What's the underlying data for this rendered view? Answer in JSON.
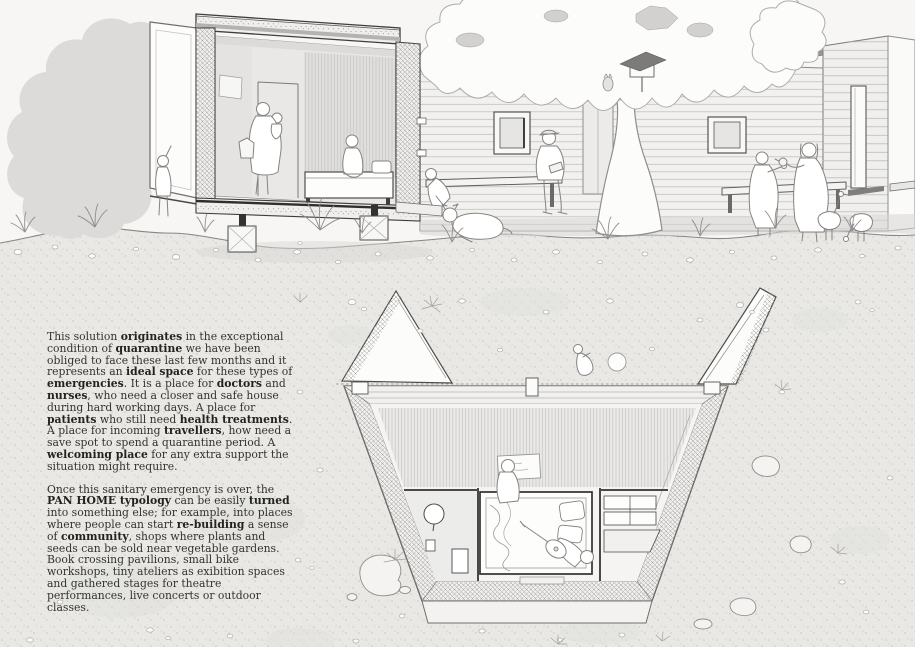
{
  "palette": {
    "paper": "#f7f6f4",
    "ink": "#4a4948",
    "earth": "#e9e8e5",
    "bush": "#dcdbd9",
    "roof_wood": "#b4b3b1",
    "roof_dark": "#9a9997",
    "figure_line": "#84837f",
    "stipple": "#b3b2b0"
  },
  "text_panel": {
    "paragraphs": [
      {
        "name": "quarantine-origin",
        "segments": [
          {
            "t": "This solution "
          },
          {
            "t": "originates",
            "b": true
          },
          {
            "t": " in the exceptional condition of "
          },
          {
            "t": "quarantine",
            "b": true
          },
          {
            "t": " we have been obliged to face these last few months and it represents an "
          },
          {
            "t": "ideal space",
            "b": true
          },
          {
            "t": " for these types of "
          },
          {
            "t": "emergencies",
            "b": true
          },
          {
            "t": ". It is a place for "
          },
          {
            "t": "doctors",
            "b": true
          },
          {
            "t": " and "
          },
          {
            "t": "nurses",
            "b": true
          },
          {
            "t": ", who need a closer and safe house during hard working days. A place for "
          },
          {
            "t": "patients",
            "b": true
          },
          {
            "t": " who still need "
          },
          {
            "t": "health treatments",
            "b": true
          },
          {
            "t": ". A place for incoming "
          },
          {
            "t": "travellers",
            "b": true
          },
          {
            "t": ", how need a save spot to spend a quarantine period. A "
          },
          {
            "t": "welcoming place",
            "b": true
          },
          {
            "t": " for any extra support the situation might require."
          }
        ]
      },
      {
        "name": "after-emergency",
        "segments": [
          {
            "t": "Once this sanitary emergency is over, the "
          },
          {
            "t": "PAN HOME typology",
            "b": true
          },
          {
            "t": " can be easily "
          },
          {
            "t": "turned",
            "b": true
          },
          {
            "t": " into something else;  for example, into places where people can start "
          },
          {
            "t": "re-building",
            "b": true
          },
          {
            "t": " a sense of "
          },
          {
            "t": "community",
            "b": true
          },
          {
            "t": ", shops where plants and seeds can be sold near vegetable gardens. Book crossing pavilions, small bike workshops, tiny ateliers as exibition spaces and gathered stages for theatre performances, live concerts or outdoor classes."
          }
        ]
      }
    ]
  }
}
